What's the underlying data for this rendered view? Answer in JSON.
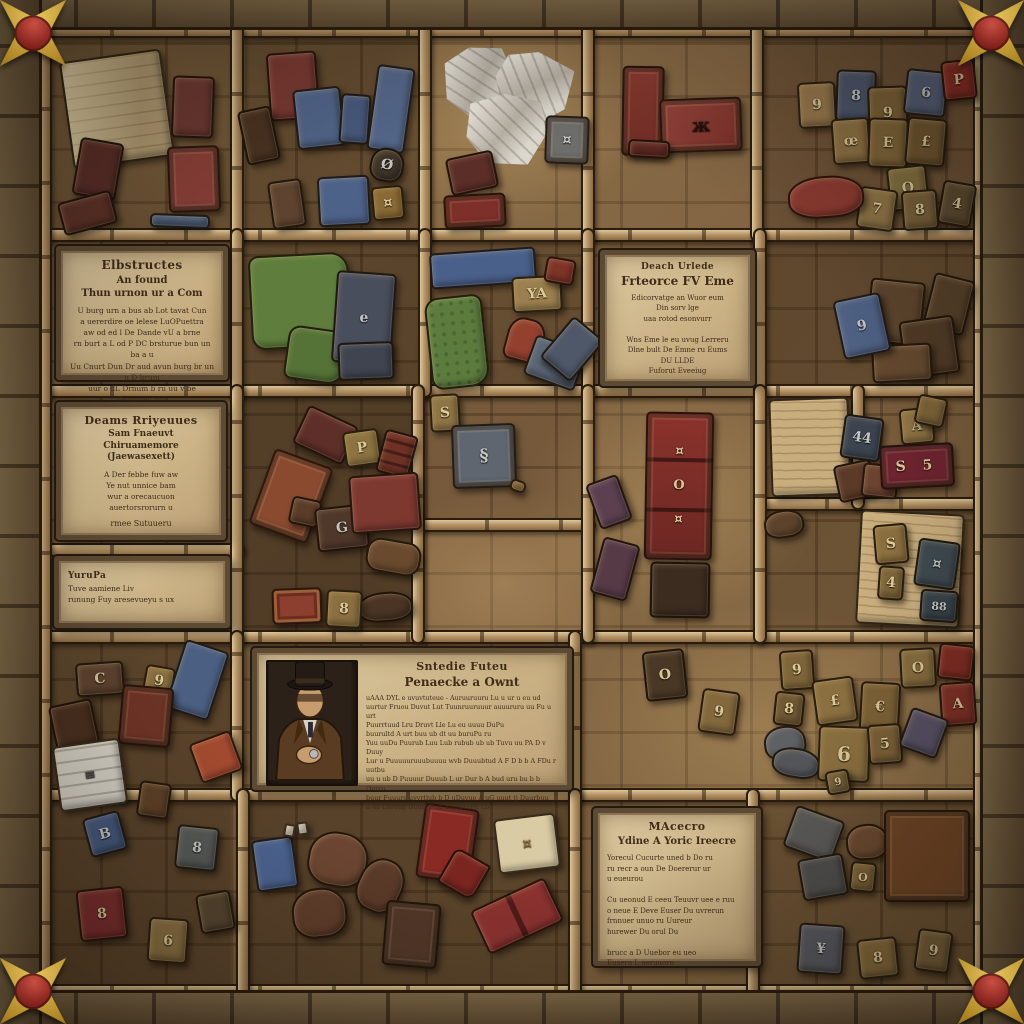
{
  "palette": {
    "stone_border": "#6f5c41",
    "wood_beam": "#b79669",
    "floor_brown": "#7c6140",
    "parchment": "#cbb386",
    "ink": "#3f2c18",
    "corner_gold": "#b38a28",
    "corner_gem_red": "#7e1f1a",
    "book_red": "#7a322c",
    "card_blue": "#4e6184",
    "cloth_green": "#5f7d3c"
  },
  "plaques": {
    "top_left": {
      "title": "Elbstructes",
      "subtitle": "An found\nThun urnon ur a Com",
      "body": "U burg urn a bus ab Lot tavat Cun\na uererdire oe lelese LuOPuettra\naw od ed l De Dande vU a brne\nrn burt a L od P DC brsturue bun un ba a u\nUu Cnurt Dun Dr aud avun burg br un u D brum\nuur o dL Drnum b ru uu v be Dnnmreu org"
    },
    "dreams_left": {
      "title": "Deams Rriyeuues",
      "subtitle": "Sam Fnaeuvt Chiruamemore\n(Jaewasexett)",
      "body": "A Der febbe fuw aw\nYe nut unnice bam\nwur a orecaucuon\nauertorsrorurn u",
      "footer": "rmee Sutuueru"
    },
    "small_left": {
      "title": "YuruPa",
      "body": "Tuve aamiene Liv\nrunung Fuy aresevueyu s ux"
    },
    "death_right": {
      "title": "Deach Urlede",
      "subtitle": "Frteorce FV Eme",
      "body": "Edicorvatge an Wuor eum\nDin sorv lge\nuaa rotod esonvurr\n\nWns Eme le eu uvug Lerreru\nDlne bult De Emne ru Eums\nDU LLDE\nFuforut Eveeiug"
    },
    "detective_center": {
      "title": "Sntedie Futeu",
      "subtitle": "Penaecke a Ownt",
      "body": "uAAA DYL e uvuvtuteue - Auruuruuru Lu u ur u eu ud\nuurtur Fruou Duvut Lut Tuunruuruuur auuururu uu Fu u urt\nPuurrtuud Lru Druvt Lle Lu eu uuuu DuPu\nbuurultd A urt buu ub dt uu buruPu ru\nYuu uuDu Puurub Luu   Lub rubub ub ub Tuvu uu PA D v Duuy\nLur u Puuuuuruuubuuuu wvb Duuubtud A F D b b A FDu r uutbu\nuu u ub D Puuuur Duuub L ur Dur b A bud uru bu b b Ourru\nbuur Fuuure uvvrtlub b D uDuvue A uG uuut tj Duurbuu\nu ub Luruug Duurt F ur ub buruPu Lb"
    },
    "magic_bottom": {
      "title": "MAcecro",
      "subtitle": "Ydine A Yoric Ireecre",
      "body": "Yorecul Cucurte uned b Do ru\nru recr a oun De Doererur ur\nu eueurou\n\nCu ueonud E ceeu Teuuvr uee e ruu\no neue E Deve Euser Du uvrerun\nfrnnuer unuo ru Uureur\nhurewer Du orul Du\n\nbrucc a D Uuebor eu ueo\nEuseru L oeruuoro"
    }
  },
  "glyphs": {
    "t01": "9",
    "t02": "8",
    "t03": "9",
    "t04": "6",
    "t05": "P",
    "t06": "œ",
    "t07": "E",
    "t08": "£",
    "t09": "O",
    "t10": "7",
    "t11": "8",
    "t12": "4",
    "pouch_dark": "Ø",
    "pouch_tan": "¤",
    "gray_book": "¤",
    "spider": "ж",
    "slate_b2": "e",
    "tan_c2": "YA",
    "b3_p": "P",
    "b3_g": "G",
    "b3_8": "8",
    "c3_s": "S",
    "c3_plaque": "§",
    "e2_9": "9",
    "e3_44": "44",
    "e3_a": "A",
    "e3_s5": "S 5",
    "e4_s": "S",
    "e4_4": "4",
    "e4_x": "¤",
    "e4_88": "88",
    "a5_c": "C",
    "a5_9": "9",
    "a5_b": "B",
    "a5_8": "8",
    "a6_8": "8",
    "a6_6": "6",
    "papers": "≡",
    "r5_o": "O",
    "r5_9": "9",
    "r5_8": "8",
    "r5_lb": "£",
    "r5_eu": "€",
    "r5_6": "6",
    "r5_5": "5",
    "r5_a": "A",
    "r5_s9": "9",
    "cab": "¤\nO\n¤",
    "d6_o": "O",
    "d6_y": "¥",
    "d6_8": "8",
    "d6_9": "9",
    "cream": "¤"
  }
}
